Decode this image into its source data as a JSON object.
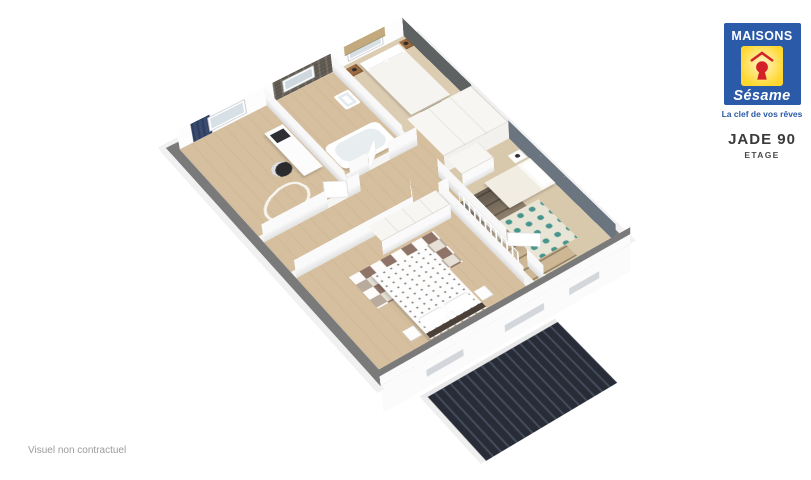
{
  "brand": {
    "name_top": "MAISONS",
    "name_bottom": "Sésame",
    "tagline": "La clef de vos rêves",
    "logo_icons": [
      "roof-outline-icon",
      "keyhole-icon"
    ]
  },
  "plan": {
    "title": "JADE 90",
    "subtitle": "ETAGE"
  },
  "footer": {
    "disclaimer": "Visuel non contractuel"
  },
  "colors": {
    "brand_blue": "#2a5aa8",
    "brand_yellow": "#ffd72e",
    "brand_red": "#d42127",
    "title_text": "#3a3a3a",
    "disclaimer_text": "#9b9b9b",
    "wall_top_gray": "#7a7a7a",
    "floor_wood": "#d5bf9e",
    "accent_dark_gray": "#5e6263",
    "accent_slate_blue": "#6b7580",
    "stone_wall": "#635d54",
    "curtain_navy": "#2e3f60",
    "blind_tan": "#c3aa7e",
    "rug_teal": "#47958d",
    "roof_dark": "#272c37",
    "nightstand_wood": "#9c6b3f"
  }
}
